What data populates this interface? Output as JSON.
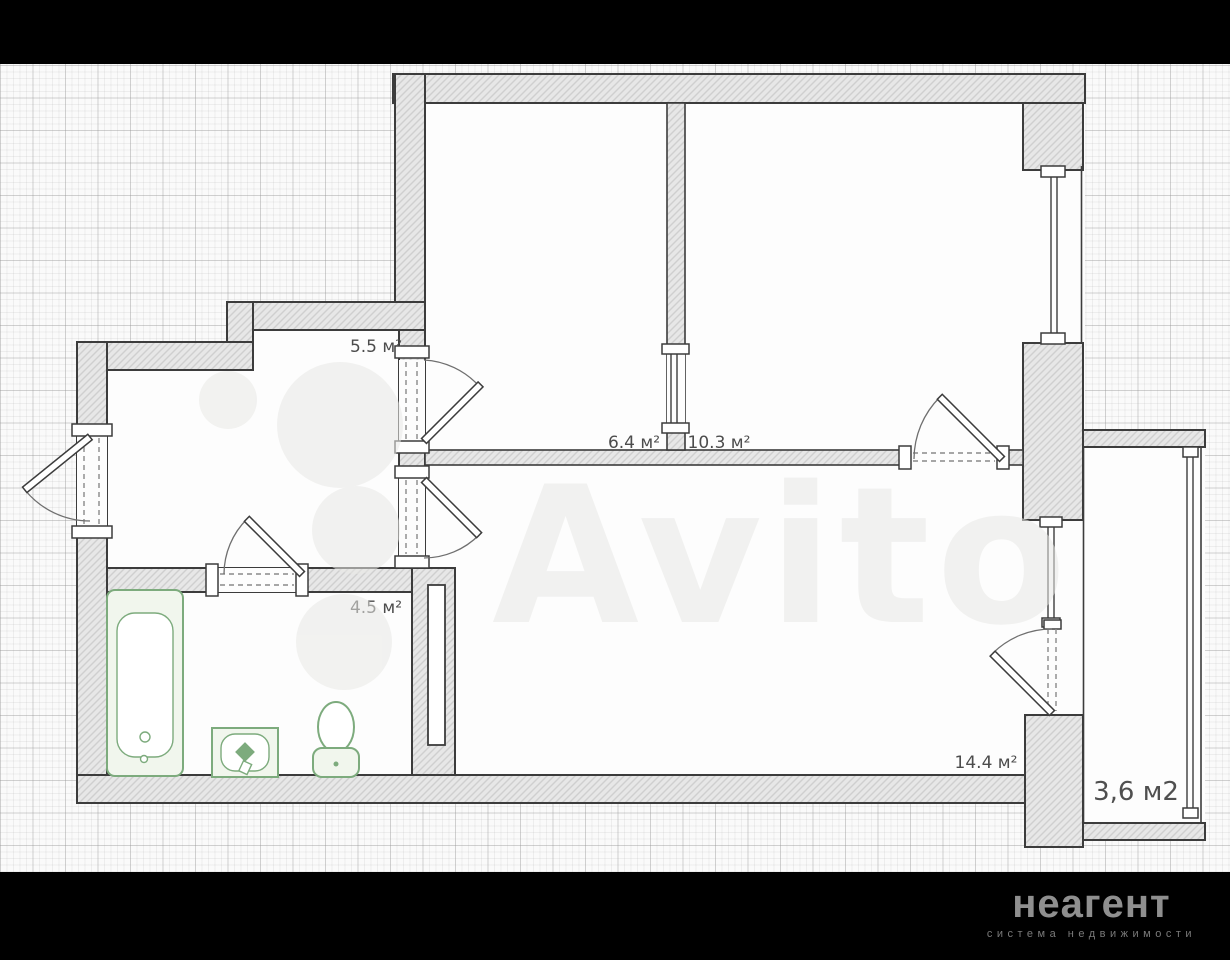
{
  "plan": {
    "rooms": [
      {
        "id": "hallway",
        "label": "5.5 м²"
      },
      {
        "id": "room-6-4",
        "label": "6.4 м²"
      },
      {
        "id": "room-10-3",
        "label": "10.3 м²"
      },
      {
        "id": "bathroom",
        "label": "4.5 м²"
      },
      {
        "id": "living-room",
        "label": "14.4 м²"
      },
      {
        "id": "balcony",
        "label": "3,6 м2"
      }
    ],
    "fixtures": [
      "bathtub",
      "sink",
      "toilet"
    ],
    "colors": {
      "wall_outline": "#3c3c3c",
      "wall_hatch_fill": "#e7e7e7",
      "fixture_green": "#7dab7d",
      "label_text": "#4c4c4c",
      "paper": "#fafafa",
      "letterbox": "#000000",
      "logo_text": "#8f8f8f",
      "tagline_text": "#7a7a7a"
    }
  },
  "watermark": {
    "text": "Avito"
  },
  "branding": {
    "logo": "неагент",
    "tagline": "система недвижимости"
  }
}
